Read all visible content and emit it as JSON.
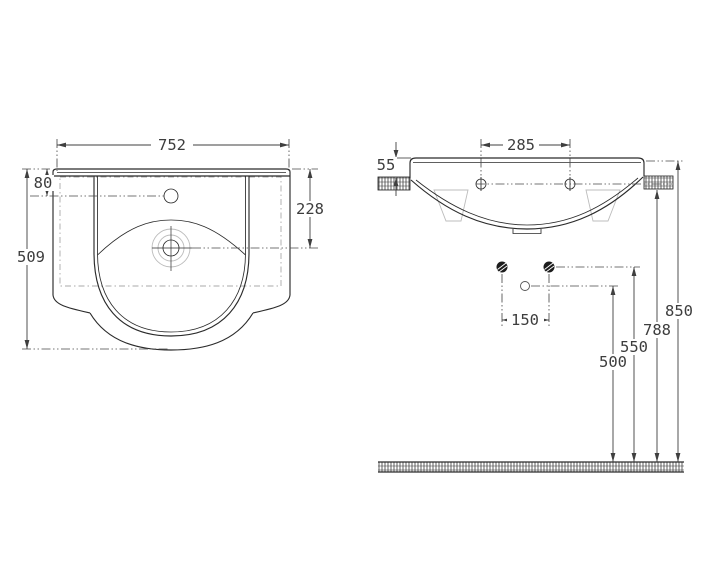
{
  "title": "Washbasin technical dimension drawing",
  "colors": {
    "background": "#ffffff",
    "line": "#2b2b2b",
    "dimension_text": "#3d3d3d",
    "centerline": "#4a4a4a",
    "light_gray": "#bcbcbc"
  },
  "plan_view": {
    "name": "basin plan view",
    "dims": {
      "overall_width": "752",
      "overall_depth": "509",
      "tap_center_offset": "80",
      "drain_center_depth": "228"
    }
  },
  "elevation_view": {
    "name": "basin front elevation",
    "dims": {
      "tap_hole_spacing": "285",
      "rim_above_shelf": "55",
      "fixing_bolt_spacing": "150",
      "trap_outlet_height": "500",
      "fixing_bolt_height": "550",
      "shelf_underside_height": "788",
      "rim_top_height": "850"
    }
  }
}
